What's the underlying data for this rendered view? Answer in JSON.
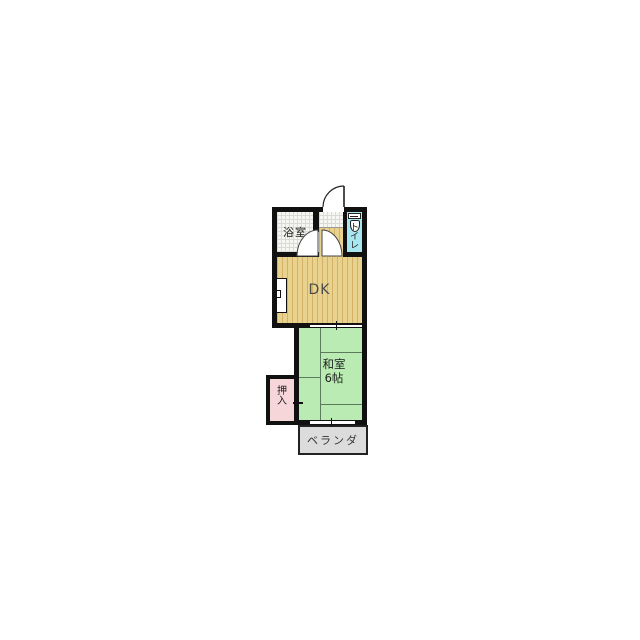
{
  "floorplan": {
    "title": "apartment-floorplan-1dk",
    "rooms": {
      "bathroom": {
        "label": "浴室"
      },
      "toilet": {
        "label": "トイレ",
        "label_chars": [
          "ト",
          "イ",
          "レ"
        ]
      },
      "dining_kitchen": {
        "label": "DK"
      },
      "japanese_room": {
        "label": "和室",
        "size_label": "6帖"
      },
      "closet": {
        "label": "押入",
        "label_chars": [
          "押",
          "入"
        ]
      },
      "veranda": {
        "label": "ベランダ"
      }
    },
    "colors": {
      "wall": "#111111",
      "dk_floor": "#e9d18e",
      "dk_stripe": "#d3b168",
      "tatami": "#b9ebb2",
      "tatami_line": "#5c7a5c",
      "toilet_floor": "#a9e7f0",
      "closet_fill": "#f7d6d9",
      "veranda_fill": "#dcdcdc",
      "bath_pattern": "#f6f6f3"
    }
  }
}
